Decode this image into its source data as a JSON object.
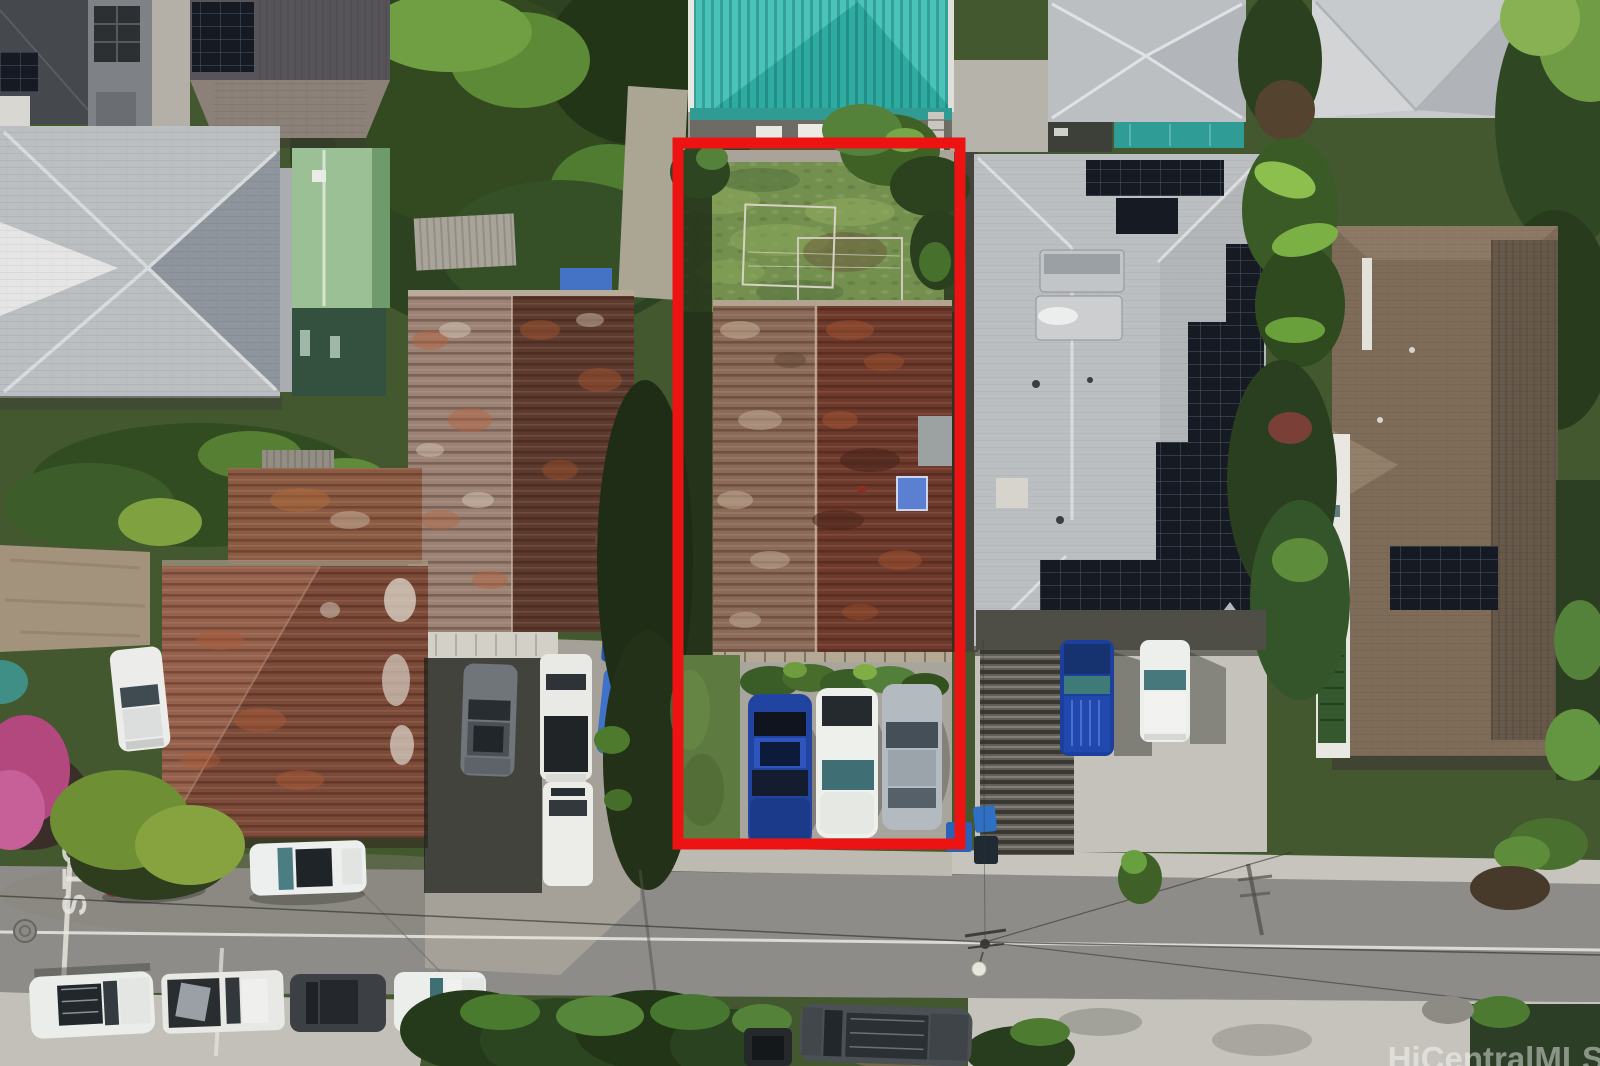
{
  "annotation": {
    "outline_color": "#ee1313"
  },
  "watermark": {
    "text": "HiCentralMLS",
    "color": "#ffffff"
  },
  "road": {
    "stop_marking": "STOP",
    "asphalt": "#8d8c88",
    "lane_line": "#e9e9e3"
  },
  "palette": {
    "teal_roof": "#4cc3b9",
    "solar_panel": "#161b23",
    "grass": "#74904e",
    "rust_weathered": "#9b8275",
    "rust_maroon": "#5d3a2e",
    "subject_rust_light": "#8a6a58",
    "subject_rust_dark": "#6e3a2c",
    "concrete": "#c5c3bc",
    "gray_roof": "#bcbfc1",
    "brown_roof": "#7e6c59",
    "vegetation": "#43582f"
  }
}
